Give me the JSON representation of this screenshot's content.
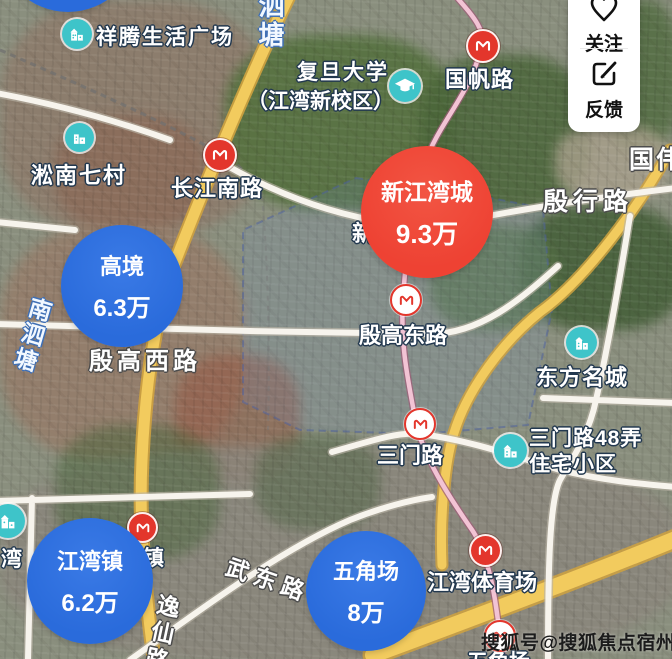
{
  "price_bubbles": [
    {
      "name": "高境",
      "price": "6.3万"
    },
    {
      "name": "新江湾城",
      "price": "9.3万"
    },
    {
      "name": "江湾镇",
      "price": "6.2万"
    },
    {
      "name": "五角场",
      "price": "8万"
    }
  ],
  "metro_stations": [
    {
      "name": "长江南路"
    },
    {
      "name": "国帆路"
    },
    {
      "name": "殷高东路"
    },
    {
      "name": "三门路"
    },
    {
      "name": "江湾镇"
    },
    {
      "name": "江湾体育场"
    },
    {
      "name": "五角场"
    },
    {
      "name": "新江湾城"
    }
  ],
  "pois": [
    {
      "name": "祥腾生活广场"
    },
    {
      "name": "淞南七村"
    },
    {
      "name": "复旦大学",
      "name2": "（江湾新校区）"
    },
    {
      "name": "东方名城"
    },
    {
      "name": "三门路48弄",
      "name2": "住宅小区"
    },
    {
      "name": "湾"
    }
  ],
  "roads": [
    {
      "name": "殷行路"
    },
    {
      "name": "殷高西路"
    },
    {
      "name": "武东路"
    },
    {
      "name": "逸仙路"
    },
    {
      "name": "国伟路"
    }
  ],
  "waterways": [
    {
      "name": "泗塘"
    },
    {
      "name": "南泗塘"
    }
  ],
  "action_panel": {
    "follow_label": "关注",
    "feedback_label": "反馈"
  },
  "watermark": "搜狐号@搜狐焦点宿州站",
  "colors": {
    "bubble_blue": "#2a6bdb",
    "bubble_red": "#ee4233",
    "metro_red": "#e3362c",
    "poi_teal": "#3ec4c9",
    "road_yellow": "#f2cb5e",
    "metro_line_pink": "#f2c3d4"
  }
}
